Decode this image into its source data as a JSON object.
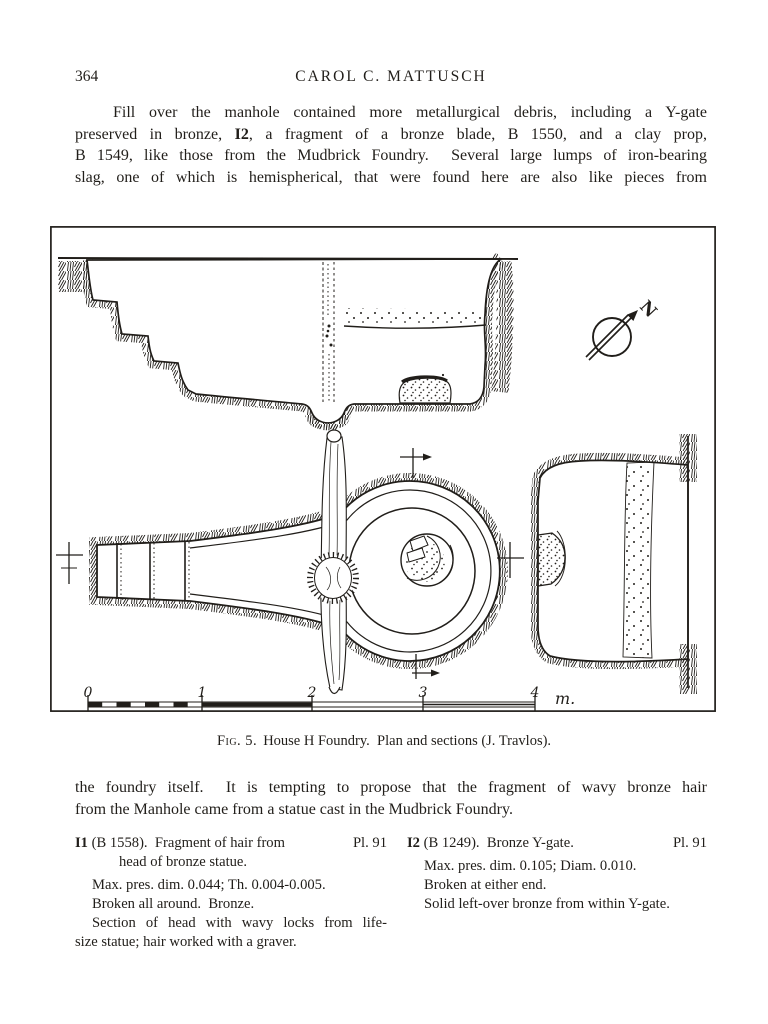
{
  "page": {
    "number": "364",
    "running_head": "CAROL C. MATTUSCH"
  },
  "intro": {
    "line1": "Fill over the manhole contained more metallurgical debris, including a Y-gate",
    "line2_pre": "preserved in bronze, ",
    "line2_bold": "I2",
    "line2_post": ", a fragment of a bronze blade, B 1550, and a clay prop,",
    "line3": "B 1549, like those from the Mudbrick Foundry.  Several large lumps of iron-bearing",
    "line4": "slag, one of which is hemispherical, that were found here are also like pieces from"
  },
  "figure": {
    "caption_label": "Fig. 5.",
    "caption_text": "House H Foundry.  Plan and sections (J. Travlos).",
    "north_label": "N",
    "scale_ticks": [
      "0",
      "1",
      "2",
      "3",
      "4"
    ],
    "scale_unit": "m."
  },
  "closing": {
    "line1": "the foundry itself.  It is tempting to propose that the fragment of wavy bronze hair",
    "line2": "from the Manhole came from a statue cast in the Mudbrick Foundry."
  },
  "catalog": {
    "entries": [
      {
        "id": "I1",
        "heading": " (B 1558).  Fragment of hair from",
        "heading_cont": "head of bronze statue.",
        "plate": "Pl. 91",
        "dim": "Max. pres. dim. 0.044; Th. 0.004-0.005.",
        "condition": "Broken all around.  Bronze.",
        "desc1": "Section of head with wavy locks from life-",
        "desc2": "size statue; hair worked with a graver."
      },
      {
        "id": "I2",
        "heading": " (B 1249).  Bronze Y-gate.",
        "heading_cont": "",
        "plate": "Pl. 91",
        "dim": "Max. pres. dim. 0.105; Diam. 0.010.",
        "condition": "Broken at either end.",
        "desc1": "Solid left-over bronze from within Y-gate.",
        "desc2": ""
      }
    ]
  },
  "colors": {
    "ink": "#211e1a",
    "paper": "#ffffff"
  }
}
